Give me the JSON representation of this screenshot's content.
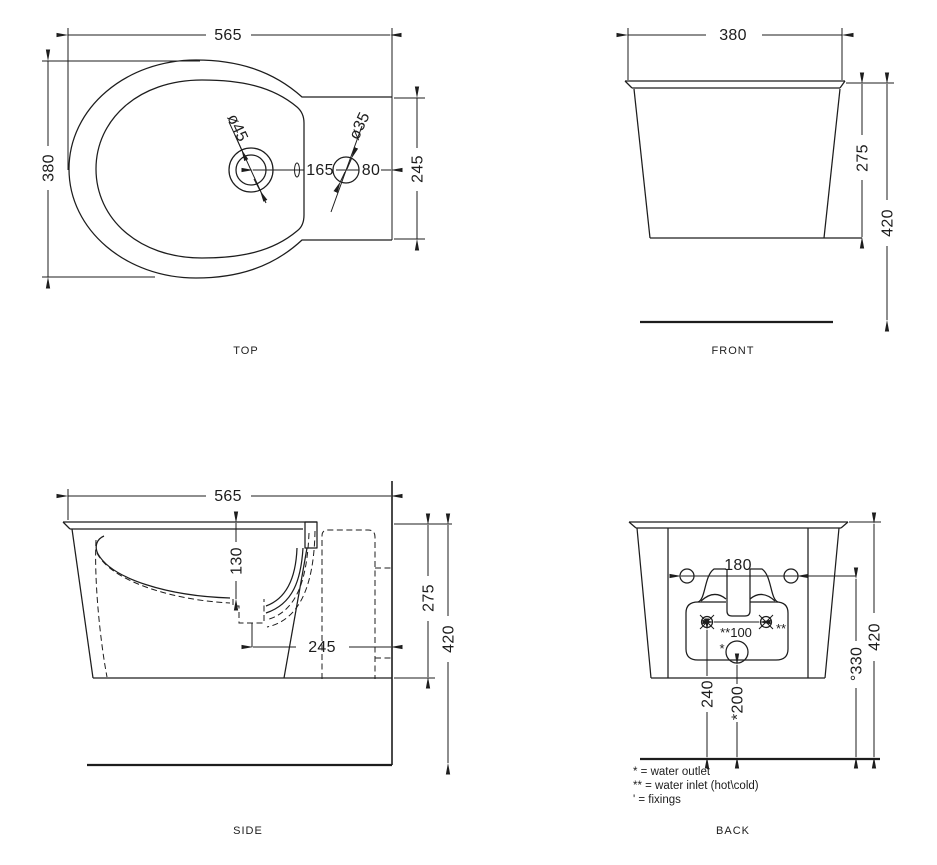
{
  "drawing": {
    "background": "#ffffff",
    "line_color": "#1d1d1d",
    "views": {
      "top": {
        "label": "TOP",
        "width": "565",
        "depth": "380",
        "drain_diameter": "ø45",
        "inlet_diameter": "ø35",
        "drain_to_inlet": "165",
        "inlet_to_wall": "80",
        "cutout_width": "245"
      },
      "front": {
        "label": "FRONT",
        "width": "380",
        "rim_height": "275",
        "total_height": "420"
      },
      "side": {
        "label": "SIDE",
        "length": "565",
        "bowl_depth": "130",
        "drain_to_wall": "245",
        "rim_height": "275",
        "total_height": "420"
      },
      "back": {
        "label": "BACK",
        "fixing_centres": "180",
        "inlet_centres": "**100",
        "inlet_marker": "**",
        "outlet_marker": "*",
        "inlet_height": "240",
        "outlet_height": "*200",
        "fixing_height": "°330",
        "total_height": "420"
      }
    },
    "legend": {
      "outlet": "* = water outlet",
      "inlet": "** = water inlet (hot\\cold)",
      "fixings": "' = fixings"
    }
  }
}
